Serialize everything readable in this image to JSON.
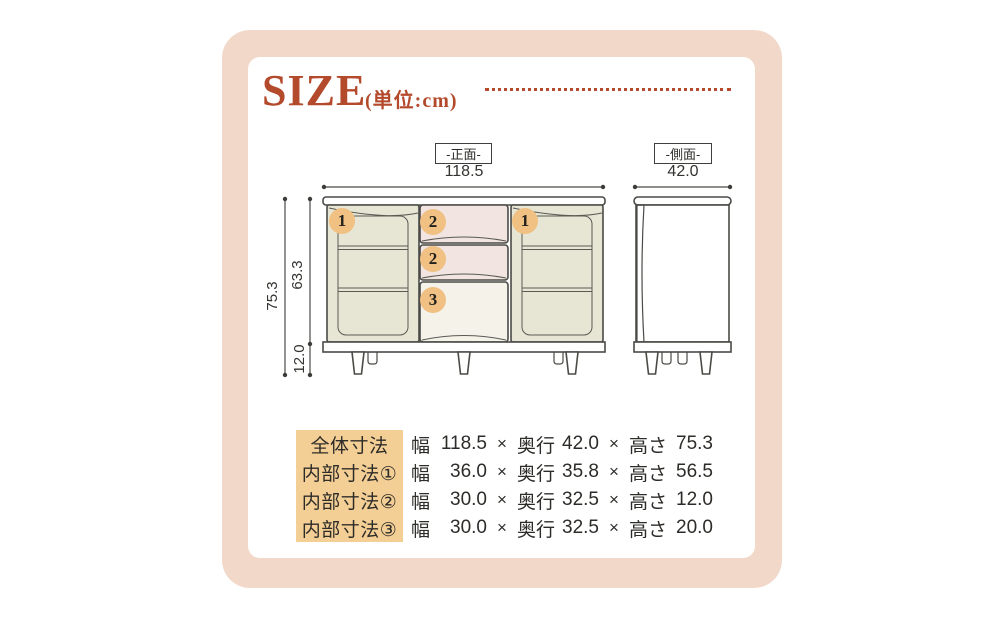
{
  "header": {
    "title": "SIZE",
    "unit_note": "(単位:cm)"
  },
  "colors": {
    "frame_pink": "#f2d8c9",
    "title_red": "#b44a2c",
    "outline_gray": "#4a4a46",
    "door_beige": "#e7e6d4",
    "drawer_pink": "#f1e4e1",
    "drawer_cream": "#f5f2e9",
    "badge_tan": "#f0c183",
    "label_highlight": "#f4cf95",
    "text_dark": "#2e2c29"
  },
  "diagram": {
    "front_view": {
      "label": "-正面-",
      "width": "118.5",
      "total_height": "75.3",
      "body_height": "63.3",
      "leg_height": "12.0",
      "badges": [
        "1",
        "2",
        "1",
        "2",
        "3"
      ]
    },
    "side_view": {
      "label": "-側面-",
      "depth": "42.0"
    }
  },
  "spec_table": {
    "columns": {
      "width": "幅",
      "depth": "奥行",
      "height": "高さ",
      "separator": "×"
    },
    "rows": [
      {
        "label": "全体寸法",
        "width": "118.5",
        "depth": "42.0",
        "height": "75.3"
      },
      {
        "label": "内部寸法①",
        "width": "36.0",
        "depth": "35.8",
        "height": "56.5"
      },
      {
        "label": "内部寸法②",
        "width": "30.0",
        "depth": "32.5",
        "height": "12.0"
      },
      {
        "label": "内部寸法③",
        "width": "30.0",
        "depth": "32.5",
        "height": "20.0"
      }
    ]
  }
}
